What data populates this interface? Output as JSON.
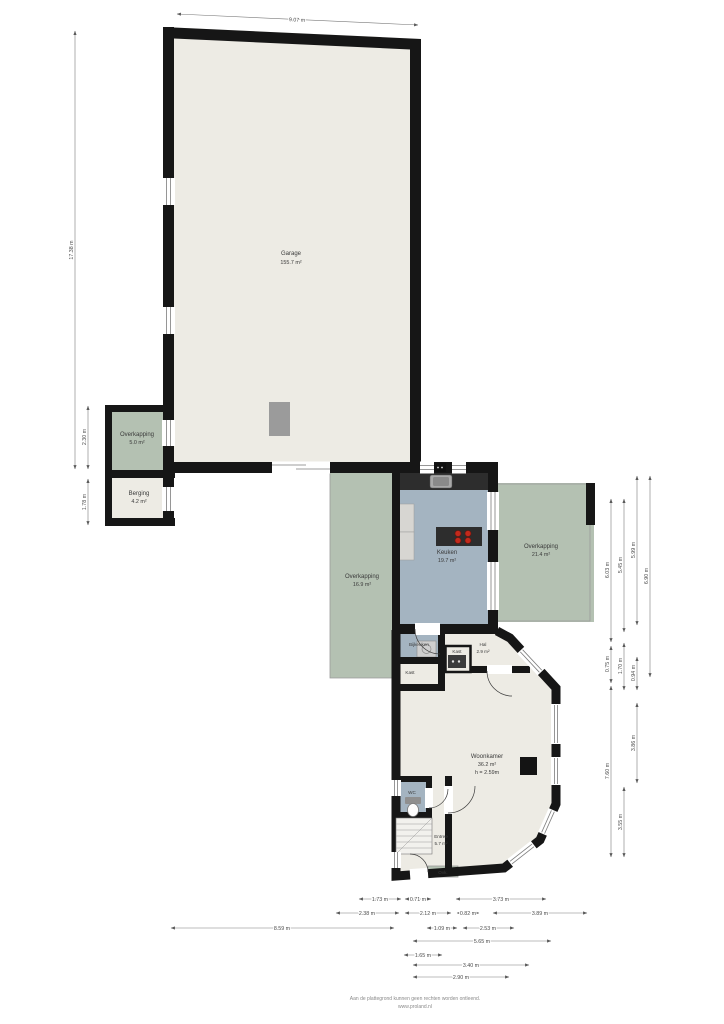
{
  "meta": {
    "type": "floor-plan"
  },
  "colors": {
    "wall": "#161616",
    "room_beige": "#edebe4",
    "room_green": "#b4c1b2",
    "room_blue": "#a4b4c1",
    "counter_dark": "#2d2d2d",
    "burner_red": "#c22a1c",
    "furniture_gray": "#9b9b9b",
    "background": "#ffffff"
  },
  "rooms": {
    "garage": {
      "label": "Garage",
      "area": "155.7 m²"
    },
    "overkapping_small": {
      "label": "Overkapping",
      "area": "5.0 m²"
    },
    "berging": {
      "label": "Berging",
      "area": "4.2 m²"
    },
    "overkapping_mid": {
      "label": "Overkapping",
      "area": "16.9 m²"
    },
    "keuken": {
      "label": "Keuken",
      "area": "19.7 m²"
    },
    "overkapping_right": {
      "label": "Overkapping",
      "area": "21.4 m²"
    },
    "bijkeuken": {
      "label": "Bijkeuken"
    },
    "kast_left": {
      "label": "Kast"
    },
    "kast_mid": {
      "label": "Kast"
    },
    "hal": {
      "label": "Hal",
      "area": "2.9 m²"
    },
    "woonkamer": {
      "label": "Woonkamer",
      "area": "36.2 m²",
      "height": "h = 2.59m"
    },
    "wc": {
      "label": "WC"
    },
    "entree": {
      "label": "Entree",
      "area": "5.7 m²"
    },
    "ovk": {
      "label": "Ovk."
    }
  },
  "dims": {
    "top_width": "9.07 m",
    "left_total": "17.38 m",
    "left_overkapping": "2.30 m",
    "left_berging": "1.78 m",
    "right": [
      "6.03 m",
      "0.75 m",
      "7.60 m",
      "5.45 m",
      "1.70 m",
      "3.55 m",
      "5.99 m",
      "0.94 m",
      "3.86 m",
      "6.90 m"
    ],
    "bottom": [
      "1.73 m",
      "0.71 m",
      "3.73 m",
      "2.38 m",
      "2.12 m",
      "0.82 m",
      "3.89 m",
      "8.59 m",
      "1.09 m",
      "2.53 m",
      "5.65 m",
      "1.65 m",
      "3.40 m",
      "2.90 m"
    ]
  },
  "footer": {
    "line1": "Aan de plattegrond kunnen geen rechten worden ontleend.",
    "line2": "www.proland.nl"
  }
}
